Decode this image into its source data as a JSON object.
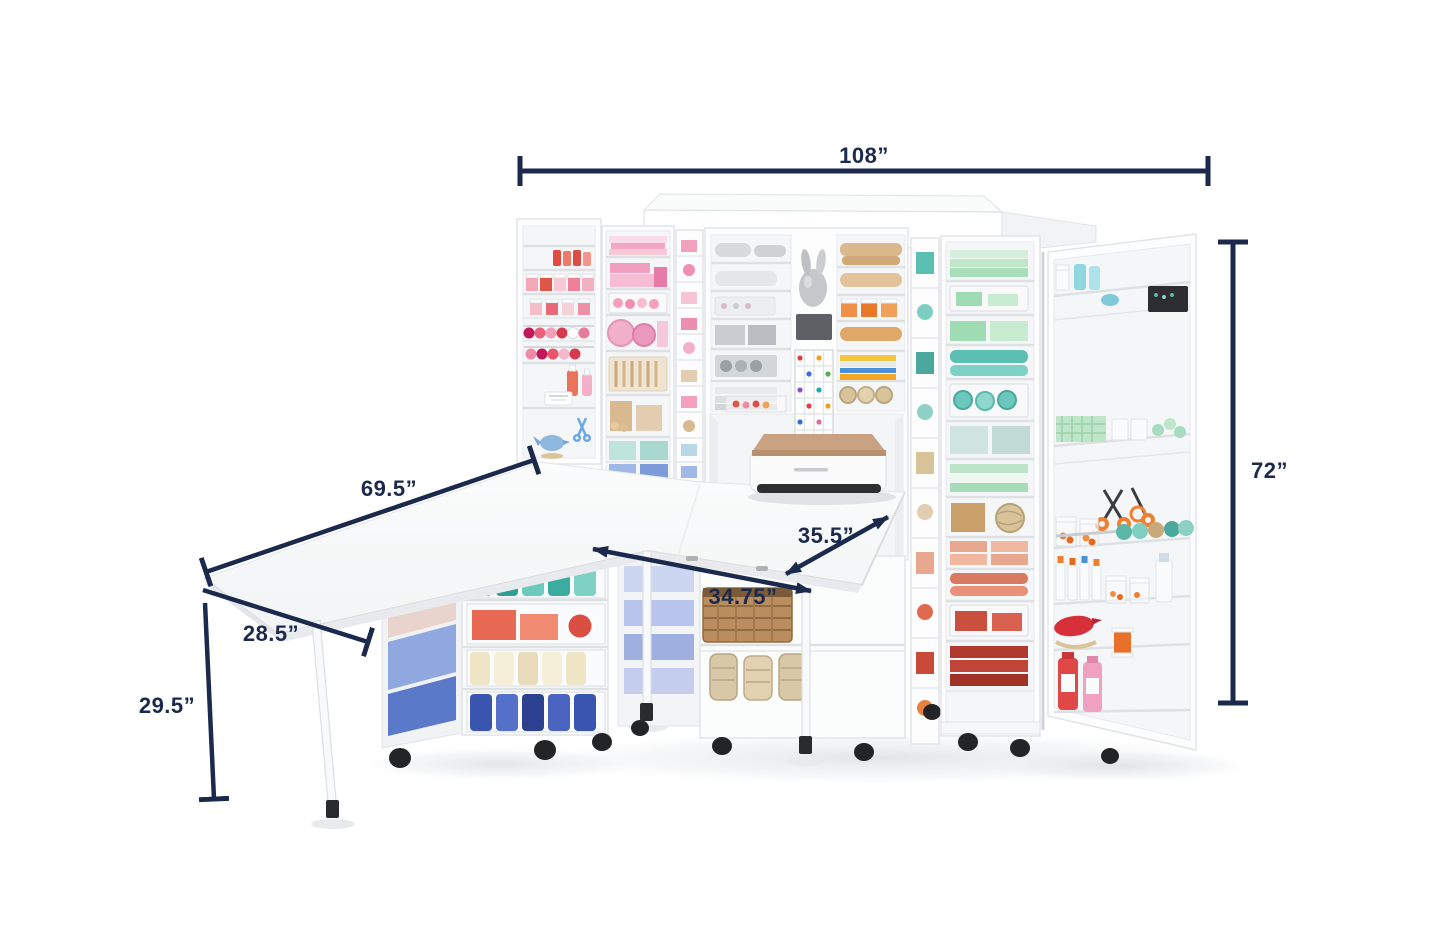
{
  "page": {
    "background_color": "#ffffff"
  },
  "annotations": {
    "color": "#1b2a4c",
    "items": [
      {
        "id": "overall-width",
        "label": "108”",
        "style": "end-ticks"
      },
      {
        "id": "overall-height",
        "label": "72”",
        "style": "end-ticks"
      },
      {
        "id": "side-table-length",
        "label": "69.5”",
        "style": "end-ticks"
      },
      {
        "id": "side-table-depth",
        "label": "28.5”",
        "style": "end-tick"
      },
      {
        "id": "table-height",
        "label": "29.5”",
        "style": "end-tick"
      },
      {
        "id": "front-table-depth",
        "label": "35.5”",
        "style": "arrows"
      },
      {
        "id": "front-table-width",
        "label": "34.75”",
        "style": "arrows"
      }
    ]
  },
  "product": {
    "type": "craft-storage-cabinet-with-fold-out-tables",
    "palette": {
      "annotation_navy": "#1b2a4c",
      "cabinet_white": "#fdfdfe",
      "shelf_line": "#dde1e4",
      "pink": "#f2a8c4",
      "light_pink": "#f7cfdd",
      "red": "#d94f43",
      "coral": "#e8745c",
      "salmon": "#e8a78f",
      "tan": "#d9b98c",
      "kraft": "#c9a06a",
      "teal": "#4fb8ac",
      "mint": "#b8e4c6",
      "aqua": "#8fd6df",
      "blue": "#3a55b0",
      "periwinkle": "#8fa8e0",
      "orange": "#f08030",
      "yellow": "#f5c542",
      "gray": "#c9ccd0",
      "silver": "#c6c7ca",
      "rose_gold": "#c9a183",
      "black": "#232426"
    }
  }
}
